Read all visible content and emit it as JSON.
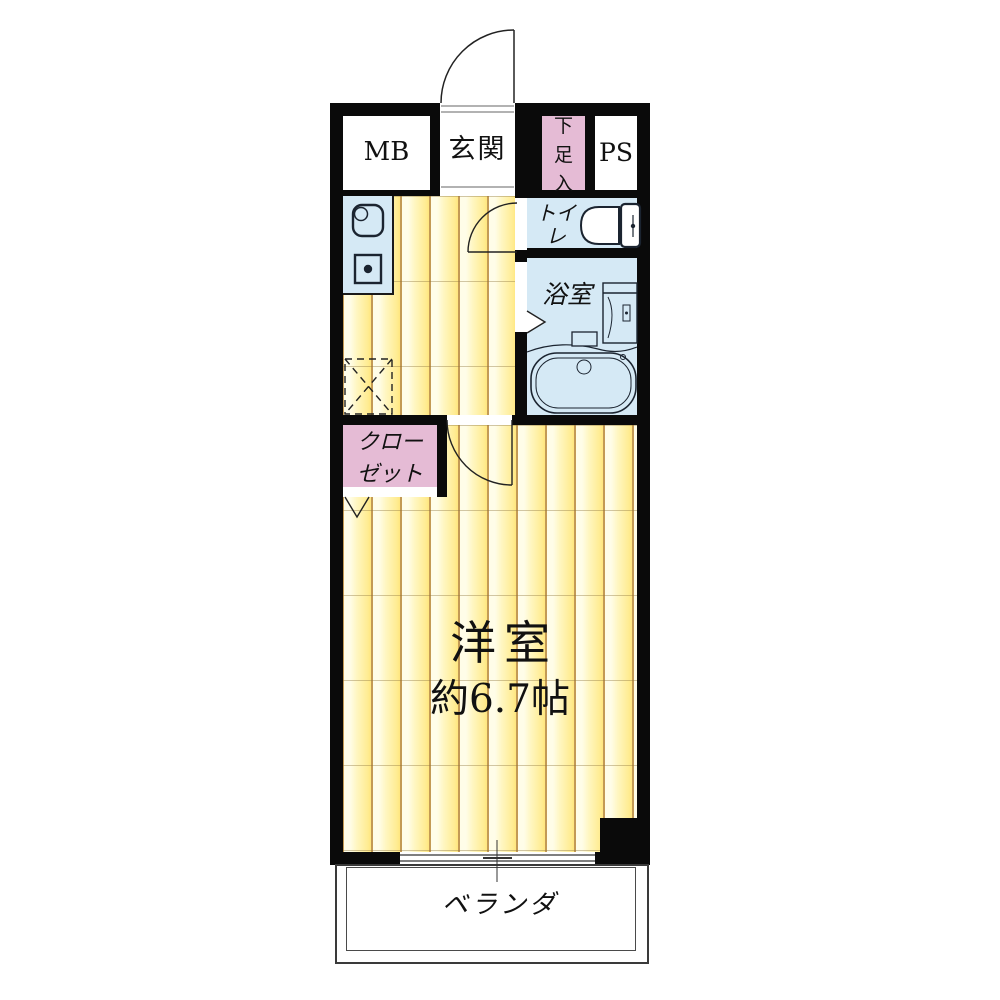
{
  "plan": {
    "top_row": {
      "mb": "MB",
      "genkan": "玄関",
      "shoe_cabinet": [
        "下",
        "足",
        "入"
      ],
      "ps": "PS"
    },
    "wet_area": {
      "toilet": "トイレ",
      "bath": "浴室"
    },
    "storage": {
      "closet_line1": "クロー",
      "closet_line2": "ゼット"
    },
    "main_room": {
      "name": "洋室",
      "size": "約6.7帖"
    },
    "outdoor": {
      "balcony": "ベランダ"
    },
    "colors": {
      "wall": "#0a0a0a",
      "flooring": "#fff3ae",
      "wet_room": "#d5e9f5",
      "storage_pink": "#e5bbd5",
      "background": "#ffffff"
    }
  }
}
